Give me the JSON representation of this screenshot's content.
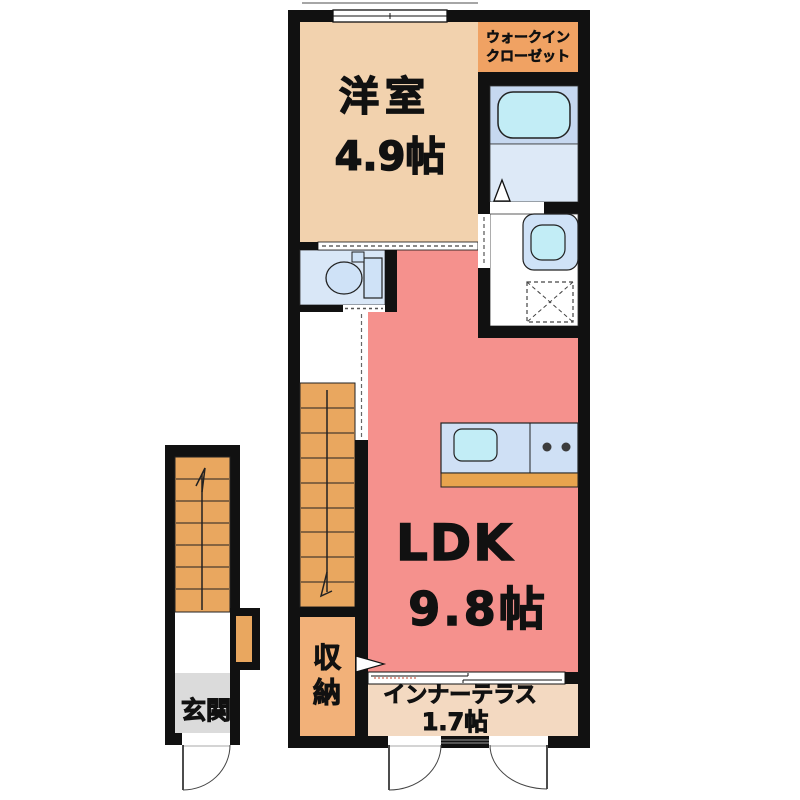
{
  "plan": {
    "rooms": {
      "western_room": {
        "name": "洋室",
        "size": "4.9帖"
      },
      "walk_in_closet": {
        "line1": "ウォークイン",
        "line2": "クローゼット"
      },
      "ldk": {
        "name": "LDK",
        "size": "9.8帖"
      },
      "inner_terrace": {
        "name": "インナーテラス",
        "size": "1.7帖"
      },
      "storage": {
        "char_top": "収",
        "char_bottom": "納"
      },
      "entrance": {
        "name": "玄関"
      }
    },
    "colors": {
      "wall": "#111111",
      "western_room": "#f2d2ae",
      "walk_in_closet": "#f0a263",
      "ldk": "#f5918d",
      "inner_terrace": "#f3d9c1",
      "storage": "#f2b179",
      "stairs": "#e9a75f",
      "entrance_floor": "#dbdbdb",
      "wet_floor": "#d9e7f7",
      "bath_band": "#c6d8f0",
      "bath_floor": "#dde9f7",
      "fixture_cyan": "#c2edf6",
      "fixture_blue": "#cfe2f7",
      "counter_blue": "#cfe0f5",
      "counter_edge": "#e8a44e"
    }
  }
}
